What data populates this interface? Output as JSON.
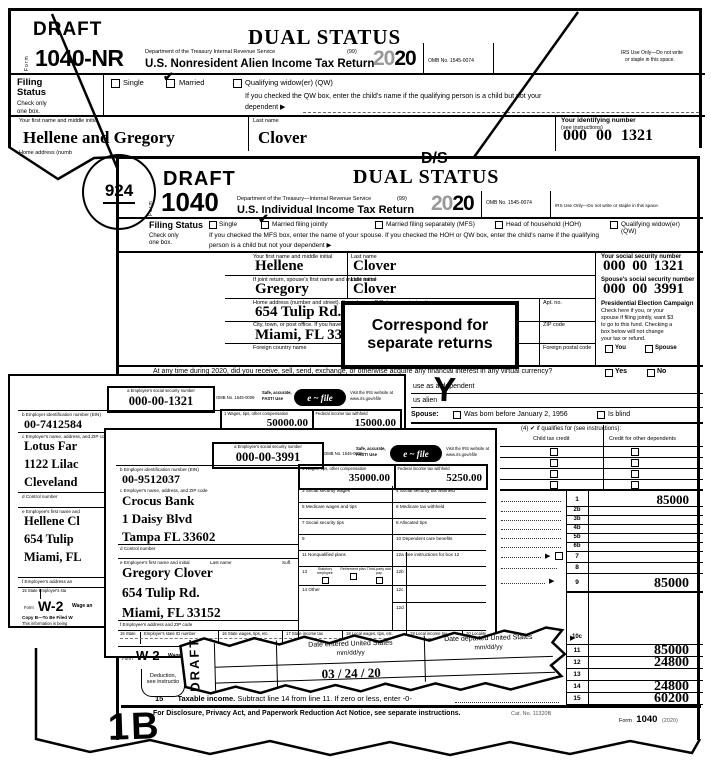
{
  "form1040nr": {
    "draft": "DRAFT",
    "dual_status": "DUAL STATUS",
    "form_word": "Form",
    "form_number": "1040-NR",
    "dept": "Department of the Treasury    Internal Revenue Service",
    "ninety_nine": "(99)",
    "title": "U.S. Nonresident Alien Income Tax Return",
    "year_outline": "20",
    "year_bold": "20",
    "omb": "OMB No. 1545-0074",
    "irs_use_1": "IRS Use Only—Do not write",
    "irs_use_2": "or staple in this space.",
    "filing_1": "Filing",
    "filing_2": "Status",
    "check_only_1": "Check only",
    "check_only_2": "one box.",
    "opt_single": "Single",
    "opt_married": "Married",
    "opt_qw": "Qualifying widow(er) (QW)",
    "qw_note": "If you checked the QW box, enter the child's name if the qualifying person is a child but not your",
    "dependent_note": "dependent ▶",
    "label_first_name": "Your first name and middle initial",
    "label_last_name": "Last name",
    "label_id_1": "Your identifying number",
    "label_id_2": "(see instructions)",
    "first_name": "Hellene and Gregory",
    "last_name": "Clover",
    "id_number": "000 00 1321",
    "home_address_partial": "Home address (numb"
  },
  "form1040": {
    "circled_number": "924",
    "draft": "DRAFT",
    "handwritten_ds": "D/S",
    "dual_status": "DUAL STATUS",
    "form_word": "Form",
    "form_number": "1040",
    "dept": "Department of the Treasury—Internal Revenue Service",
    "ninety_nine": "(99)",
    "title": "U.S. Individual Income Tax Return",
    "year_outline": "20",
    "year_bold": "20",
    "omb": "OMB No. 1545-0074",
    "irs_use": "IRS Use Only—Do not write or staple in this space.",
    "filing_status": "Filing Status",
    "check_only_1": "Check only",
    "check_only_2": "one box.",
    "opt_single": "Single",
    "opt_mfj": "Married filing jointly",
    "opt_mfs": "Married filing separately (MFS)",
    "opt_hoh": "Head of household (HOH)",
    "opt_qw": "Qualifying widow(er) (QW)",
    "mfs_note_1": "If you checked the MFS box, enter the name of your spouse. If you checked the HOH or QW box, enter the child's name if the qualifying",
    "mfs_note_2": "person is a child but not your dependent ▶",
    "label_first_name": "Your first name and middle initial",
    "label_last_name": "Last name",
    "label_ssn": "Your social security number",
    "label_spouse_first": "If joint return, spouse's first name and middle initial",
    "label_spouse_ssn": "Spouse's social security number",
    "first_name": "Hellene",
    "last_name": "Clover",
    "ssn": "000 00 1321",
    "spouse_first_name": "Gregory",
    "spouse_last_name": "Clover",
    "spouse_ssn": "000 00 3991",
    "label_home": "Home address (number and street). If you have a P.O. box, see instructions.",
    "home_address": "654 Tulip Rd.",
    "label_apt": "Apt. no.",
    "label_city": "City, town, or post office. If you have a foreign address, also complete spaces below.",
    "city": "Miami, FL  33152",
    "label_zip": "ZIP code",
    "label_foreign_country": "Foreign country name",
    "label_foreign_postal": "Foreign postal code",
    "pec_title": "Presidential Election Campaign",
    "pec_1": "Check here if you, or your",
    "pec_2": "spouse if filing jointly, want $3",
    "pec_3": "to go to this fund. Checking a",
    "pec_4": "box below will not change",
    "pec_5": "your tax or refund.",
    "pec_you": "You",
    "pec_spouse": "Spouse",
    "correspond_1": "Correspond for",
    "correspond_2": "separate returns",
    "virtual_currency": "At any time during 2020, did you receive, sell, send, exchange, or otherwise acquire any financial interest in any virtual currency?",
    "yes": "Yes",
    "no": "No",
    "fragment_dependent": "use as a dependent",
    "fragment_alien": "us alien",
    "handwritten_y": "Y",
    "spouse_label": "Spouse:",
    "born_label": "Was born before January 2, 1956",
    "blind_label": "Is blind",
    "dep_header": "(4) ✔ if qualifies for (see instructions):",
    "dep_ctc": "Child tax credit",
    "dep_cod": "Credit for other dependents",
    "lines": [
      {
        "no": "1",
        "amount": "85000"
      },
      {
        "no": "2b",
        "amount": ""
      },
      {
        "no": "3b",
        "amount": ""
      },
      {
        "no": "4b",
        "amount": ""
      },
      {
        "no": "5b",
        "amount": ""
      },
      {
        "no": "6b",
        "amount": ""
      },
      {
        "no": "7",
        "amount": ""
      },
      {
        "no": "8",
        "amount": ""
      },
      {
        "no": "9",
        "amount": "85000"
      },
      {
        "no": "10c",
        "amount": ""
      },
      {
        "no": "11",
        "amount": "85000"
      },
      {
        "no": "12",
        "amount": "24800"
      },
      {
        "no": "13",
        "amount": ""
      },
      {
        "no": "14",
        "amount": "24800"
      },
      {
        "no": "15",
        "amount": "60200"
      }
    ],
    "line15_no": "15",
    "line15_bold": "Taxable income.",
    "line15_rest": " Subtract line 14 from line 11. If zero or less, enter -0-",
    "margin_note_1": "Deduction,",
    "margin_note_2": "see instructio",
    "footer": "For Disclosure, Privacy Act, and Paperwork Reduction Act Notice, see separate instructions.",
    "cat_no": "Cat. No. 11320B",
    "footer_form_word": "Form",
    "footer_form_number": "1040",
    "footer_form_year": "(2020)",
    "handwritten_1b": "1B"
  },
  "w2_hellene": {
    "a_label": "a  Employee's social security number",
    "ssn": "000-00-1321",
    "omb": "OMB No. 1545-0008",
    "safe_1": "Safe, accurate,",
    "safe_2": "FAST! Use",
    "efile": "e ~ file",
    "visit_1": "Visit the IRS website at",
    "visit_2": "www.irs.gov/efile",
    "b_label": "b  Employer identification number (EIN)",
    "ein": "00-7412584",
    "box1_label": "1    Wages, tips, other compensation",
    "box1_value": "50000.00",
    "box2_label": "2    Federal income tax withheld",
    "box2_value": "15000.00",
    "c_label": "c  Employer's name, address, and ZIP code",
    "employer_1": "Lotus Far",
    "employer_2": "1122 Lilac",
    "employer_3": "Cleveland",
    "d_label": "d  Control number",
    "e_label": "e  Employee's first name and",
    "employee_1": "Hellene Cl",
    "employee_2": "654 Tulip",
    "employee_3": "Miami, FL",
    "f_label": "f  Employee's address an",
    "state_label": "15  State    Employer's sta",
    "form_word": "Form",
    "form_number": "W-2",
    "form_title": "Wage an",
    "copy_label": "Copy B—To Be Filed W",
    "info_label": "This information is being"
  },
  "w2_gregory": {
    "a_label": "a  Employee's social security number",
    "ssn": "000-00-3991",
    "omb": "OMB No. 1545-0008",
    "safe_1": "Safe, accurate,",
    "safe_2": "FAST! Use",
    "efile": "e ~ file",
    "visit_1": "Visit the IRS website at",
    "visit_2": "www.irs.gov/efile",
    "b_label": "b  Employer identification number (EIN)",
    "ein": "00-9512037",
    "box1_label": "1    Wages, tips, other compensation",
    "box1_value": "35000.00",
    "box2_label": "2    Federal income tax withheld",
    "box2_value": "5250.00",
    "c_label": "c  Employer's name, address, and ZIP code",
    "employer_1": "Crocus Bank",
    "employer_2": "1 Daisy Blvd",
    "employer_3": "Tampa FL  33602",
    "box3_label": "3    Social security wages",
    "box4_label": "4    Social security tax withheld",
    "box5_label": "5    Medicare wages and tips",
    "box6_label": "6    Medicare tax withheld",
    "box7_label": "7    Social security tips",
    "box8_label": "8    Allocated tips",
    "box9_label": "9",
    "box10_label": "10   Dependent care benefits",
    "box11_label": "11   Nonqualified plans",
    "box12a_label": "12a  See instructions for box 12",
    "box13_label": "13",
    "box13_1": "Statutory employee",
    "box13_2": "Retirement plan",
    "box13_3": "Third-party sick pay",
    "box14_label": "14   Other",
    "box12b_label": "12b",
    "box12c_label": "12c",
    "box12d_label": "12d",
    "d_label": "d  Control number",
    "e_label": "e  Employee's first name and initial",
    "last_name_label": "Last name",
    "suff_label": "Suff.",
    "employee_1": "Gregory Clover",
    "employee_2": "654 Tulip Rd.",
    "employee_3": "Miami, FL  33152",
    "f_label": "f  Employee's address and ZIP code",
    "box15_label": "15  State",
    "box15b_label": "Employer's state ID number",
    "box16_label": "16  State wages, tips, etc.",
    "box17_label": "17  State income tax",
    "box18_label": "18  Local wages, tips, etc.",
    "box19_label": "19  Local income tax",
    "box20_label": "20  Locality",
    "form_word": "Form",
    "form_number": "W-2",
    "form_title": "Wage a"
  },
  "date_strip": {
    "draft": "DRAFT",
    "entered_label": "Date entered United States",
    "entered_format": "mm/dd/yy",
    "entered_value": "03 / 24 / 20",
    "departed_label": "Date departed United States",
    "departed_format": "mm/dd/yy"
  }
}
